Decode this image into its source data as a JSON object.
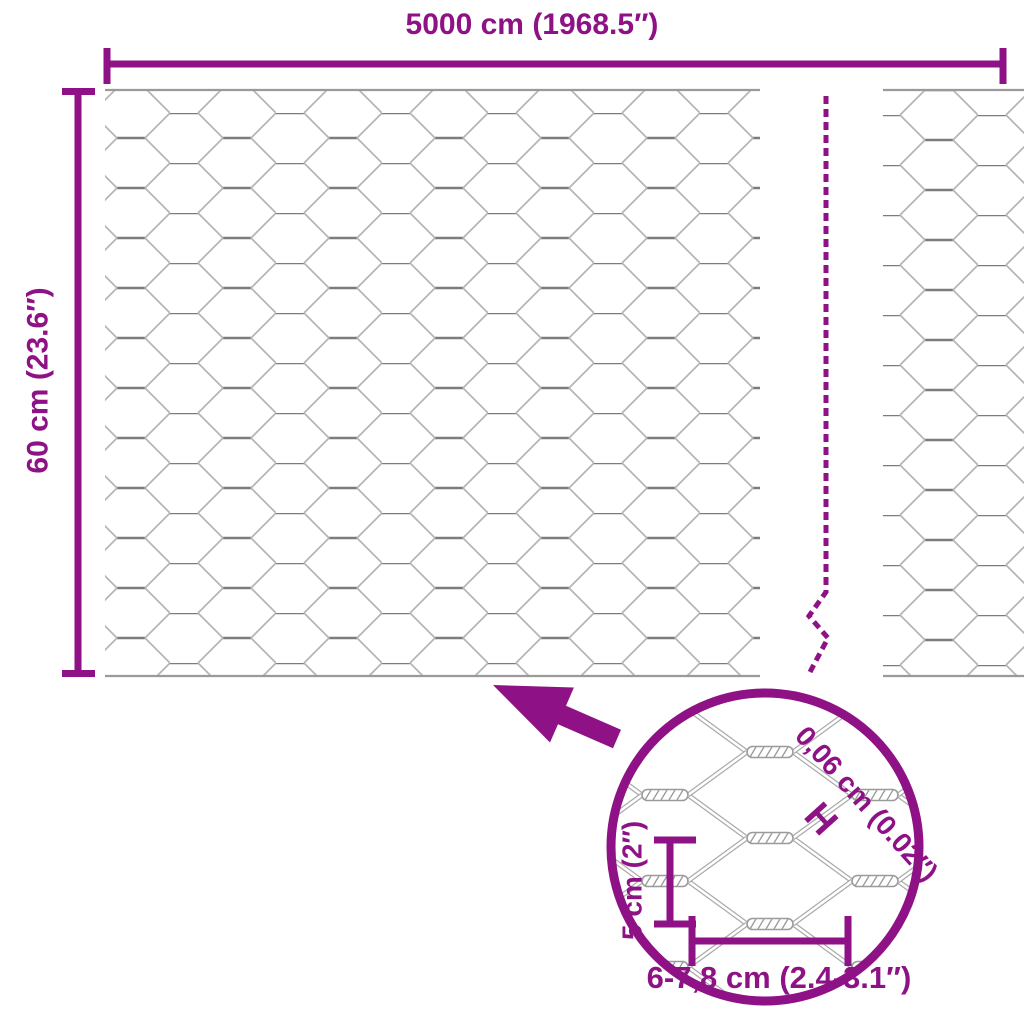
{
  "diagram_type": "product-dimension-diagram",
  "product": "hexagonal wire mesh fence roll",
  "colors": {
    "accent": "#8E1285",
    "wire_diagonal": "#b6b6b6",
    "wire_twist": "#7c7c7c",
    "wire_edge": "#9a9a9a",
    "inset_wire": "#9a9a9a"
  },
  "labels": {
    "roll_width": "5000 cm (1968.5″)",
    "roll_height": "60 cm (23.6″)"
  },
  "inset": {
    "wire_thickness": "0,06 cm (0.02″)",
    "thickness_marker": "H",
    "mesh_height": "5 cm (2″)",
    "mesh_width": "6-7,8 cm (2.4-3.1″)"
  },
  "icons": {
    "zoom_arrow": "arrow-up-left",
    "magnifier": "magnifier-circle",
    "break_line": "vertical-dashed-break"
  }
}
